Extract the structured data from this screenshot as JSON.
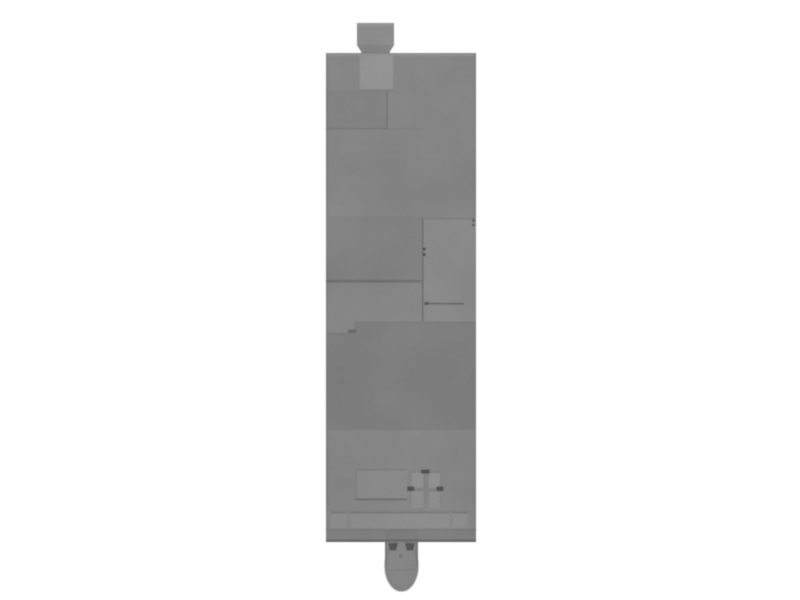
{
  "scene": {
    "background_color": "#ffffff",
    "subject": "grayscale top-down photo of a rectangular machined device"
  },
  "palette": {
    "body": "#8e8e8e",
    "body_top_highlight": "#9b9b9b",
    "knob": "#959595",
    "inlay_square": "#9d9d9d",
    "access_panel": "#929292",
    "dark_panel": "#858585",
    "recessed_tray": "#929292",
    "cross_cell_upper": "#989898",
    "cross_cell_lower": "#959595",
    "cross_base": "#898989",
    "channel_inset": "#959595",
    "base_rail": "#878787",
    "cylinder": "#8b8b8b",
    "seam_dark": "#6f6f6f",
    "edge_shadow": "#7a7a7a",
    "mark_dark": "#4f4f4f",
    "screw_dot": "#4c4c4c"
  },
  "parts": [
    {
      "name": "top-connector-knob"
    },
    {
      "name": "device-body"
    },
    {
      "name": "inlay-square"
    },
    {
      "name": "access-panel"
    },
    {
      "name": "dark-panel"
    },
    {
      "name": "recessed-tray"
    },
    {
      "name": "cross-compartment"
    },
    {
      "name": "bottom-channel"
    },
    {
      "name": "base-rail"
    },
    {
      "name": "bottom-cylinder"
    }
  ]
}
